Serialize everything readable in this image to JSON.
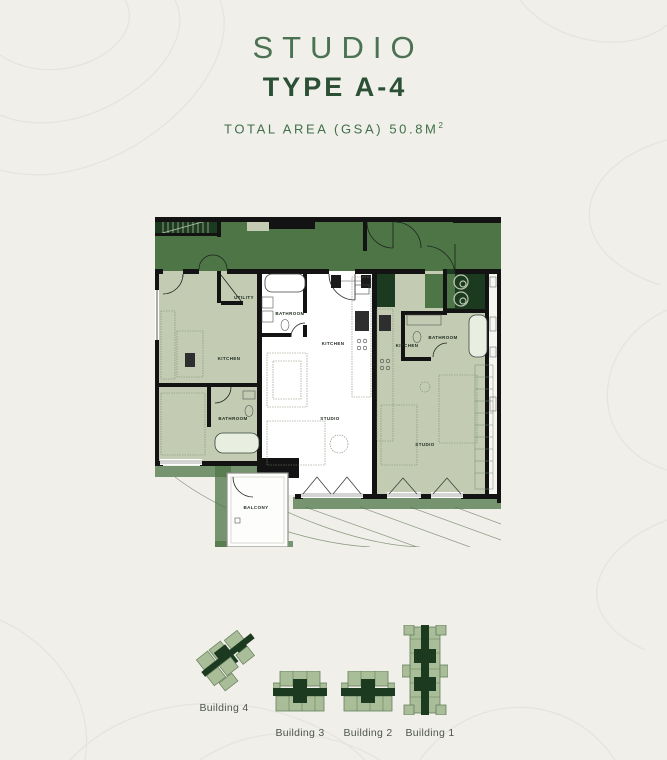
{
  "header": {
    "title": "STUDIO",
    "subtitle": "TYPE A-4",
    "area_label": "TOTAL AREA (GSA) 50.8M",
    "area_sup": "2"
  },
  "floorplan": {
    "rooms": {
      "utility": "UTILITY",
      "kitchen_left": "KITCHEN",
      "bathroom_left": "BATHROOM",
      "bathroom_center": "BATHROOM",
      "kitchen_center": "KITCHEN",
      "studio_center": "STUDIO",
      "balcony": "BALCONY",
      "kitchen_right": "KITCHEN",
      "bathroom_right": "BATHROOM",
      "studio_right": "STUDIO"
    },
    "colors": {
      "corridor_green": "#4d7546",
      "unit_green": "#c3ccb3",
      "core_dark_green": "#1c3a20",
      "wall_black": "#131313",
      "highlight_unit_white": "#ffffff"
    }
  },
  "site": {
    "buildings": [
      {
        "label": "Building 4"
      },
      {
        "label": "Building 3"
      },
      {
        "label": "Building 2"
      },
      {
        "label": "Building 1"
      }
    ],
    "icon_colors": {
      "wing_green": "#a9bd99",
      "core_green": "#1c3a20"
    }
  },
  "page": {
    "background": "#f0efe9",
    "contour_line": "#e6e4dc"
  }
}
